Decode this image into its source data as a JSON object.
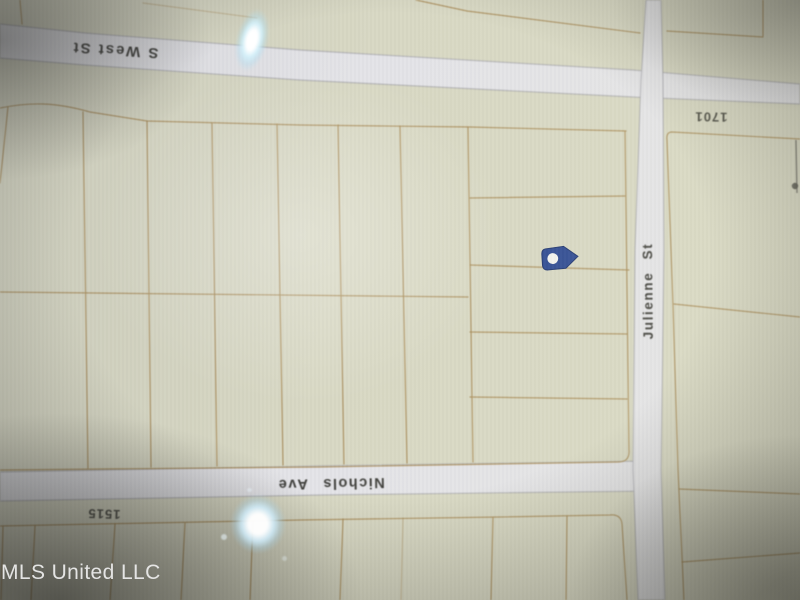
{
  "watermark": {
    "text": "MLS United LLC"
  },
  "map": {
    "kind": "plat-map-photo",
    "streets": [
      {
        "id": "s-west-st",
        "label": "S West St"
      },
      {
        "id": "nichols-ave",
        "label": "Nichols Ave"
      },
      {
        "id": "julienne-st",
        "label": "Julienne St"
      }
    ],
    "parcel_numbers": [
      {
        "id": "parcel-1701",
        "label": "1701"
      },
      {
        "id": "parcel-1515",
        "label": "1515"
      }
    ],
    "marker": {
      "name": "location-marker"
    },
    "colors": {
      "parcel_fill": "#d8d8c4",
      "street_fill": "#e4e4e8",
      "street_edge": "#9a9aa2",
      "parcel_line": "#a98c58",
      "label_text": "#3c3c38",
      "parcel_number_text": "#4a4a42",
      "marker_fill": "#2e4a93",
      "marker_stroke": "#1f3570",
      "marker_dot": "#f3f3f0",
      "watermark_color": "#ebebeb"
    }
  }
}
